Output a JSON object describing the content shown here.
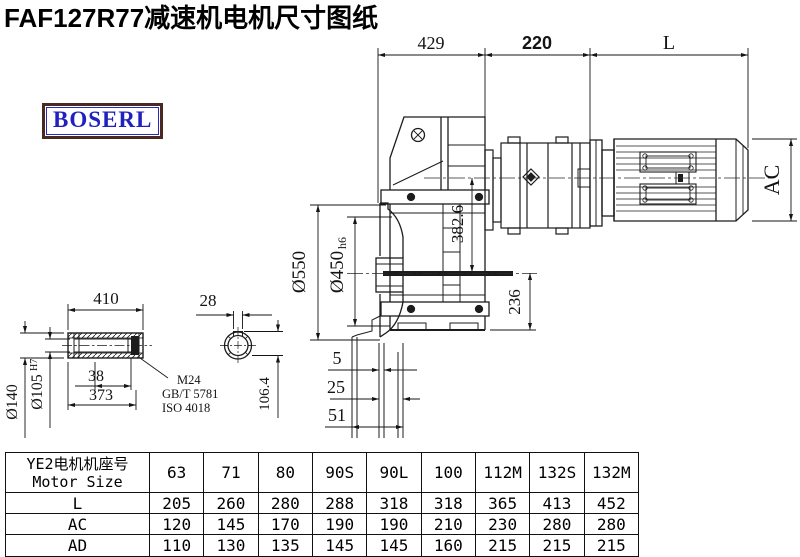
{
  "title": "FAF127R77减速机电机尺寸图纸",
  "logo": {
    "text": "BOSERL",
    "text_color": "#2121bd",
    "border_color": "#4a2a20"
  },
  "drawing": {
    "top_dims": {
      "d429": "429",
      "d220": "220",
      "dL": "L"
    },
    "right_dim_ac": "AC",
    "vertical_dims": {
      "d382_6": "382.6",
      "d236": "236"
    },
    "flange_dims": {
      "d550": "Ø550",
      "d450": "Ø450",
      "d450_tol": "h6"
    },
    "offset_dims": {
      "d5": "5",
      "d25": "25",
      "d51": "51"
    },
    "shaft_detail": {
      "d410": "410",
      "d28": "28",
      "d140": "Ø140",
      "d105": "Ø105",
      "d105_tol": "H7",
      "d38": "38",
      "d373": "373",
      "d106_4": "106.4",
      "thread": "M24",
      "std1": "GB/T 5781",
      "std2": "ISO 4018"
    }
  },
  "table": {
    "row_header_cn": "YE2电机机座号",
    "row_header_en": "Motor Size",
    "columns": [
      "63",
      "71",
      "80",
      "90S",
      "90L",
      "100",
      "112M",
      "132S",
      "132M"
    ],
    "rows": [
      {
        "label": "L",
        "values": [
          "205",
          "260",
          "280",
          "288",
          "318",
          "318",
          "365",
          "413",
          "452"
        ]
      },
      {
        "label": "AC",
        "values": [
          "120",
          "145",
          "170",
          "190",
          "190",
          "210",
          "230",
          "280",
          "280"
        ]
      },
      {
        "label": "AD",
        "values": [
          "110",
          "130",
          "135",
          "145",
          "145",
          "160",
          "215",
          "215",
          "215"
        ]
      }
    ]
  }
}
